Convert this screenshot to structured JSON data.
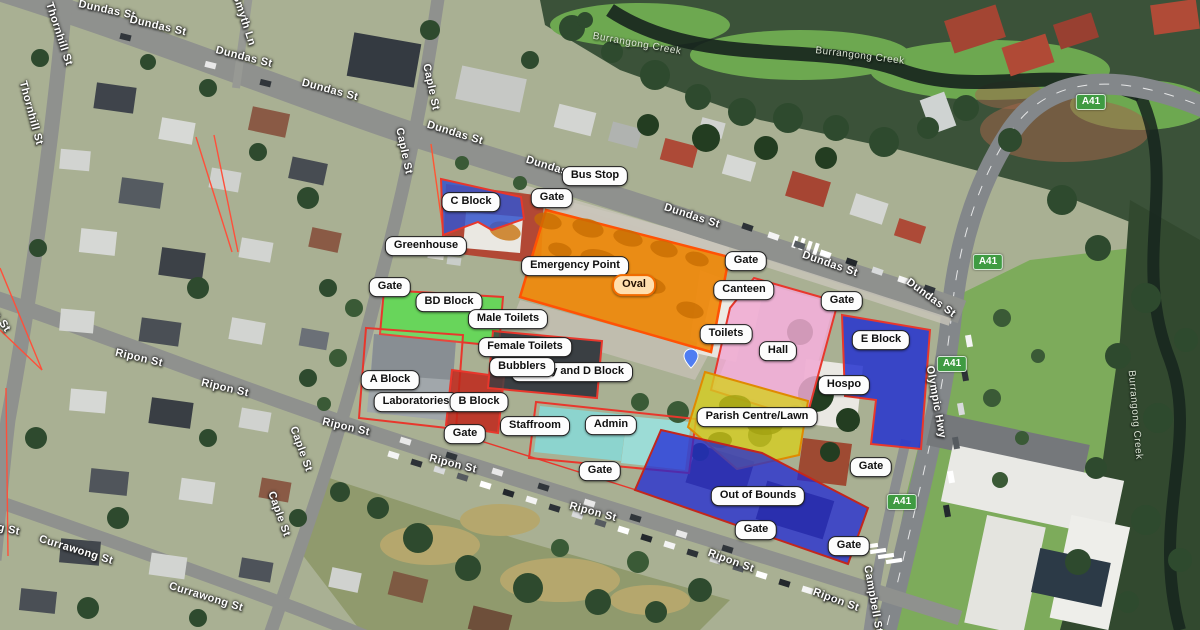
{
  "labels": {
    "bus_stop": "Bus Stop",
    "gate": "Gate",
    "c_block": "C Block",
    "greenhouse": "Greenhouse",
    "emergency_point": "Emergency Point",
    "oval": "Oval",
    "canteen": "Canteen",
    "toilets": "Toilets",
    "hall": "Hall",
    "e_block": "E Block",
    "hospo": "Hospo",
    "bd_block": "BD Block",
    "male_toilets": "Male Toilets",
    "female_toilets": "Female Toilets",
    "bubblers": "Bubblers",
    "library_d_block": "Library and D Block",
    "a_block": "A Block",
    "laboratories": "Laboratories",
    "b_block": "B Block",
    "staffroom": "Staffroom",
    "admin": "Admin",
    "parish_centre": "Parish Centre/Lawn",
    "out_of_bounds": "Out of Bounds"
  },
  "streets": {
    "dundas": "Dundas St",
    "thornhill": "Thornhill St",
    "smyth": "Smyth Ln",
    "caple": "Caple St",
    "ripon": "Ripon St",
    "currawong": "Currawong St",
    "campbell": "Campbell St",
    "olympic": "Olympic Hwy"
  },
  "creek": "Burrangong Creek",
  "route_badge": "A41",
  "zone_colors": {
    "zone_border": "#e8372c",
    "c_block_fill": "#3555cd",
    "oval_fill": "#f0890a",
    "oval_border": "#ff5205",
    "bd_block_fill": "#58df4d",
    "a_block_fill": "#ffffff",
    "b_block_fill": "#c0261a",
    "library_fill": "#3c4145",
    "hall_fill": "#f0a9d2",
    "e_block_fill": "#2532cf",
    "parish_fill": "#d6ce20",
    "parish_border": "#e08a00",
    "oob_fill": "#2028d4",
    "oob_border": "#c3271c",
    "badge_bg": "#3f9b42",
    "pin_color": "#4f7df2"
  }
}
